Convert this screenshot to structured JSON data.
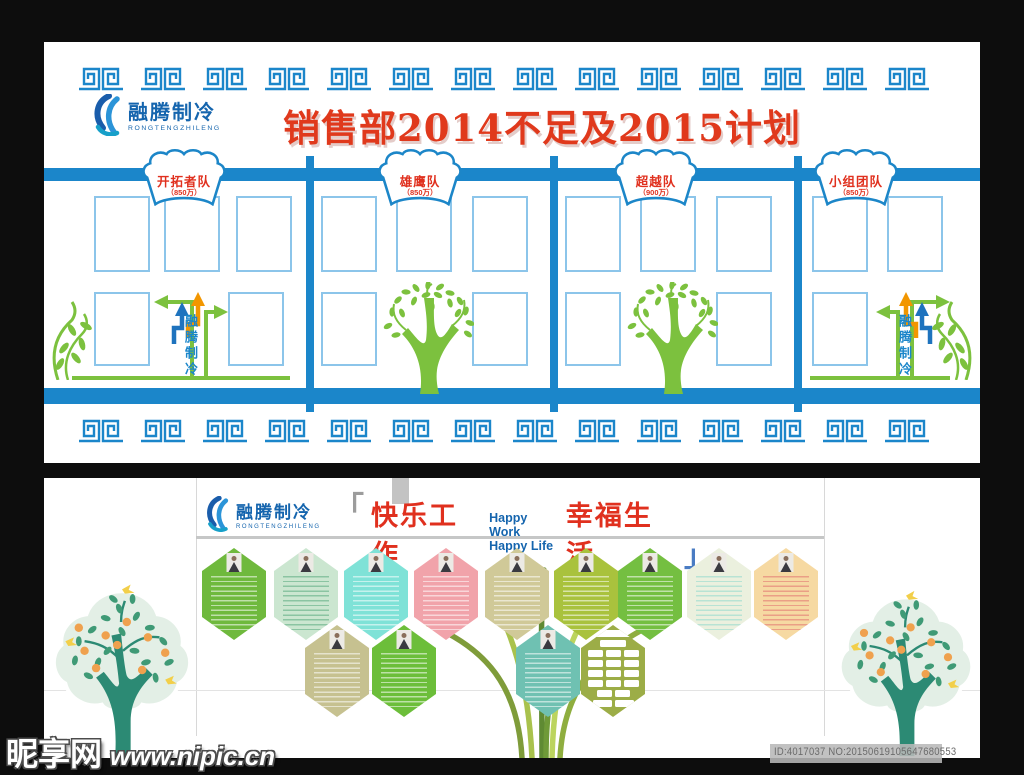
{
  "brand": {
    "name": "融腾制冷",
    "name_en": "RONGTENGZHILENG"
  },
  "top_poster": {
    "title": "销售部2014不足及2015计划",
    "teams": [
      {
        "name": "开拓者队",
        "target": "（850万）"
      },
      {
        "name": "雄鹰队",
        "target": "（850万）"
      },
      {
        "name": "超越队",
        "target": "（900万）"
      },
      {
        "name": "小组团队",
        "target": "（850万）"
      }
    ],
    "vertical_brand": "融腾制冷",
    "colors": {
      "bar_blue": "#1b86ca",
      "frame_blue": "#8cc5ea",
      "title_red": "#e0391c",
      "green": "#7cc13e",
      "orange": "#f29600",
      "arrow_blue": "#1e73be"
    }
  },
  "bottom_poster": {
    "slogan": {
      "open": "「",
      "cn_left": "快乐工作",
      "en_line1": "Happy Work",
      "en_line2": "Happy Life",
      "cn_right": "幸福生活",
      "close": "」"
    },
    "hex_rows": [
      [
        {
          "color": "#6fb93d",
          "ink": "#ffffff"
        },
        {
          "color": "#cbe6d0",
          "ink": "#57a87c"
        },
        {
          "color": "#7fe2d7",
          "ink": "#ffffff"
        },
        {
          "color": "#f1a3aa",
          "ink": "#ffffff"
        },
        {
          "color": "#d0c998",
          "ink": "#ffffff"
        },
        {
          "color": "#a9c23d",
          "ink": "#ffffff"
        },
        {
          "color": "#74bf41",
          "ink": "#ffffff"
        },
        {
          "color": "#ebf0de",
          "ink": "#8fd8cb"
        },
        {
          "color": "#f6d9a2",
          "ink": "#e07070"
        }
      ],
      [
        {
          "color": "#c6c190",
          "ink": "#ffffff"
        },
        {
          "color": "#6cbe3a",
          "ink": "#ffffff"
        },
        {
          "color": "#6fc1b2",
          "ink": "#ffffff"
        },
        {
          "color": "#9cad47",
          "ink": "#ffffff",
          "org": true
        }
      ]
    ]
  },
  "footer": {
    "site_name": "昵享网",
    "site_url": "www.nipic.cn",
    "id_text": "ID:4017037 NO:20150619105647680553"
  }
}
